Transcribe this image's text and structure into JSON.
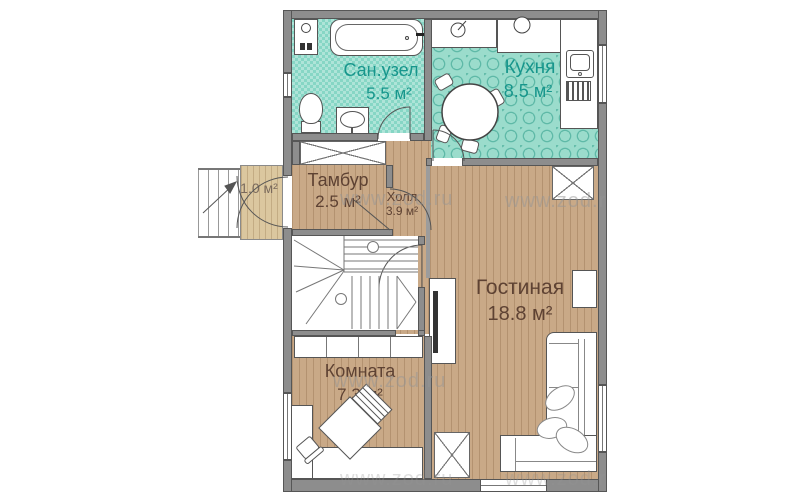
{
  "plan": {
    "title": "floor-plan",
    "rooms": [
      {
        "name": "Сан.узел",
        "area": "5.5 м²"
      },
      {
        "name": "Кухня",
        "area": "8.5 м²"
      },
      {
        "name": "Тамбур",
        "area": "2.5 м²"
      },
      {
        "name": "Холл",
        "area": "3.9 м²"
      },
      {
        "name": "Гостиная",
        "area": "18.8 м²"
      },
      {
        "name": "Комната",
        "area": "7.3 м²"
      }
    ],
    "porch_area": "1.0 м²",
    "watermark": "www.zod.ru",
    "colors": {
      "tile_floor": "#86d6c5",
      "kitchen_floor": "#9bdccc",
      "wood_floor": "#c9a987",
      "porch_floor": "#dbc79f",
      "wall": "#8d8d8d",
      "teal_label": "#17968c",
      "brown_label": "#5e4233"
    }
  }
}
